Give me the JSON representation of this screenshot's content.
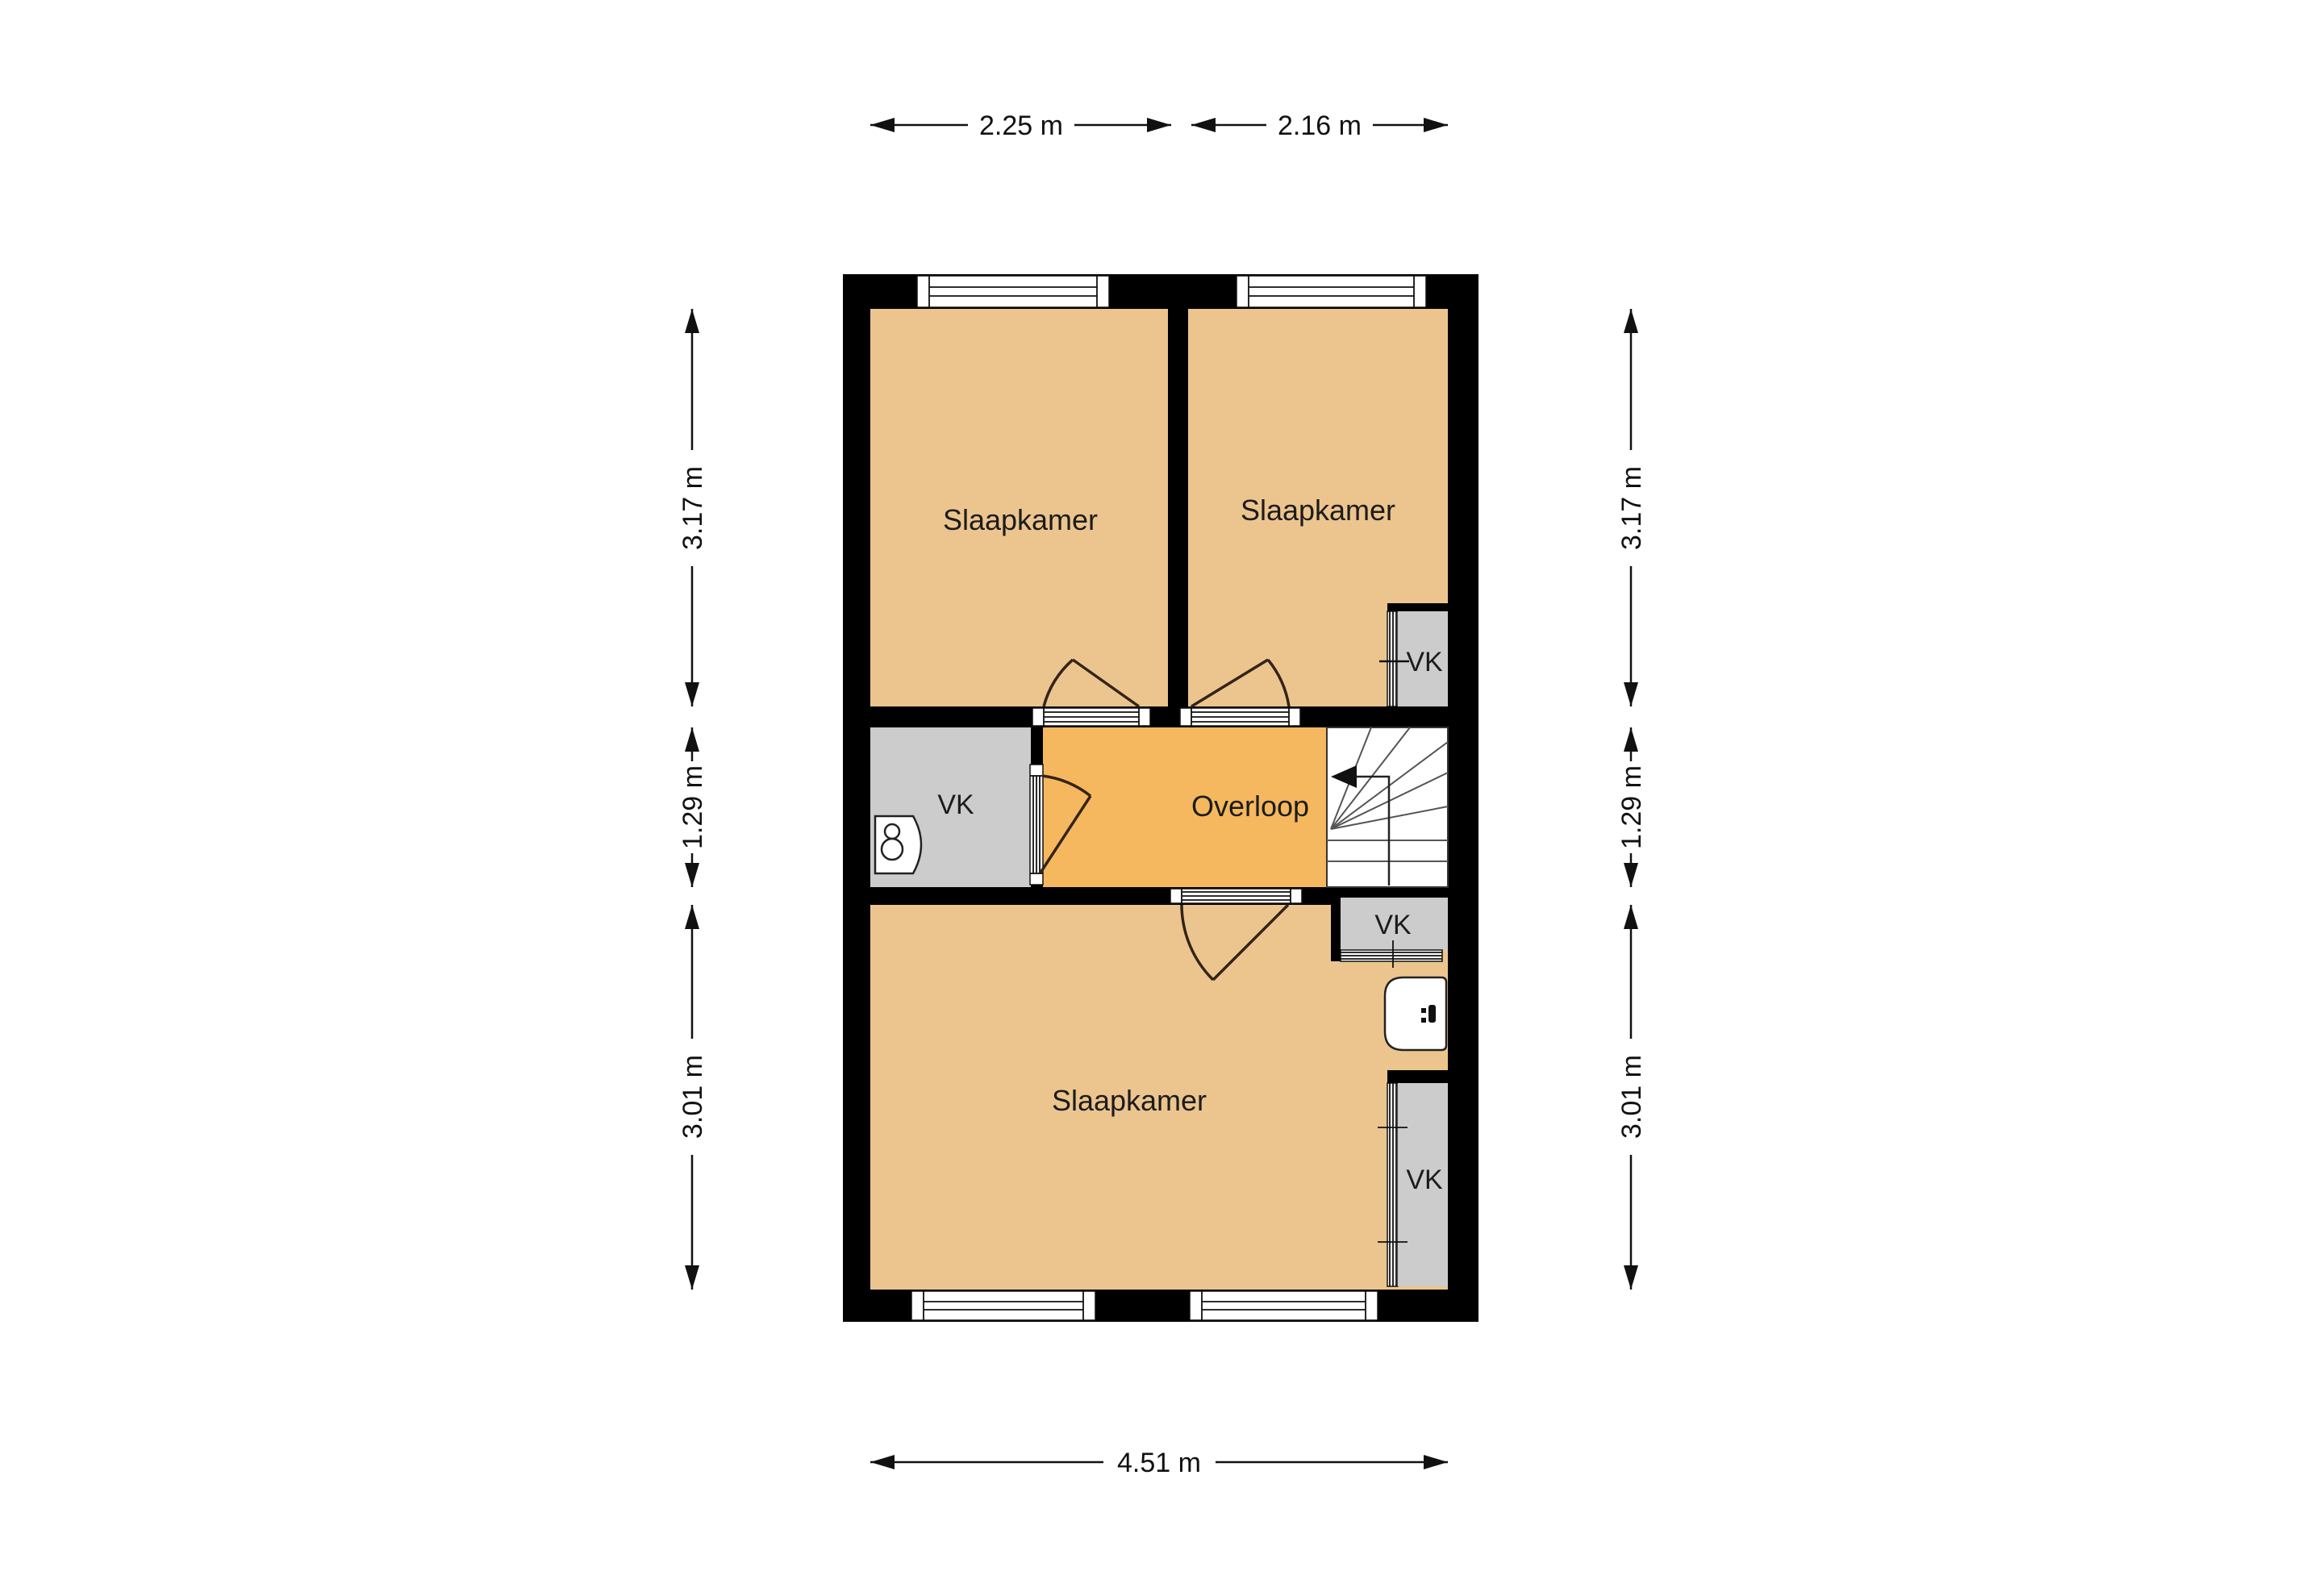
{
  "title": "Floor plan - first floor",
  "colors": {
    "floor_tan": "#ECC58E",
    "floor_amber": "#F5B85E",
    "closet_gray": "#CCCCCC",
    "wall": "#000000",
    "door": "#33241A"
  },
  "rooms": {
    "bedroom_top_left": {
      "label": "Slaapkamer"
    },
    "bedroom_top_right": {
      "label": "Slaapkamer"
    },
    "bedroom_bottom": {
      "label": "Slaapkamer"
    },
    "landing": {
      "label": "Overloop"
    },
    "closet_middle_left": {
      "label": "VK"
    },
    "closet_top_right": {
      "label": "VK"
    },
    "closet_toilet": {
      "label": "VK"
    },
    "closet_bottom_right": {
      "label": "VK"
    }
  },
  "dimensions": {
    "top": [
      {
        "label": "2.25 m"
      },
      {
        "label": "2.16 m"
      }
    ],
    "bottom": [
      {
        "label": "4.51 m"
      }
    ],
    "left": [
      {
        "label": "3.17 m"
      },
      {
        "label": "1.29 m"
      },
      {
        "label": "3.01 m"
      }
    ],
    "right": [
      {
        "label": "3.17 m"
      },
      {
        "label": "1.29 m"
      },
      {
        "label": "3.01 m"
      }
    ]
  }
}
